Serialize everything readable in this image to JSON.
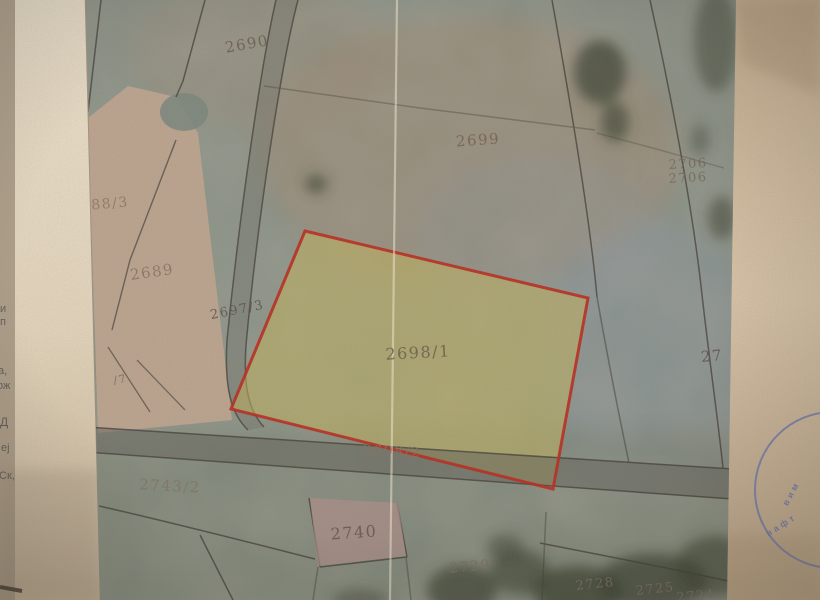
{
  "photo": {
    "description": "Photographed cadastral map sheet with highlighted parcel",
    "page_background": "#d8c2a7",
    "underlying_page": "#efe2cb",
    "map_base": "#8d968b",
    "highlight_fill": "rgba(206,188,92,0.52)",
    "highlight_stroke": "#c0281c",
    "stamp_color": "#6a77b7"
  },
  "labels": [
    {
      "id": "2690",
      "text": "2690"
    },
    {
      "id": "2699",
      "text": "2699"
    },
    {
      "id": "2706a",
      "text": "2706"
    },
    {
      "id": "2706b",
      "text": "2706"
    },
    {
      "id": "88-3",
      "text": "88/3"
    },
    {
      "id": "2689",
      "text": "2689"
    },
    {
      "id": "2697-3",
      "text": "2697/3"
    },
    {
      "id": "2698-1",
      "text": "2698/1"
    },
    {
      "id": "7",
      "text": "/7"
    },
    {
      "id": "2698-2",
      "text": "2698/2"
    },
    {
      "id": "2743-2",
      "text": "2743/2"
    },
    {
      "id": "2740",
      "text": "2740"
    },
    {
      "id": "2729",
      "text": "2729"
    },
    {
      "id": "2728",
      "text": "2728"
    },
    {
      "id": "2725",
      "text": "2725"
    },
    {
      "id": "2724",
      "text": "2724"
    },
    {
      "id": "27-cut",
      "text": "27"
    }
  ],
  "margin_fragments": [
    "и",
    "п",
    "а,",
    "ож",
    "Д",
    "еј",
    "Ск,"
  ],
  "stamp": {
    "upper": "вим",
    "lower": "нафт"
  }
}
